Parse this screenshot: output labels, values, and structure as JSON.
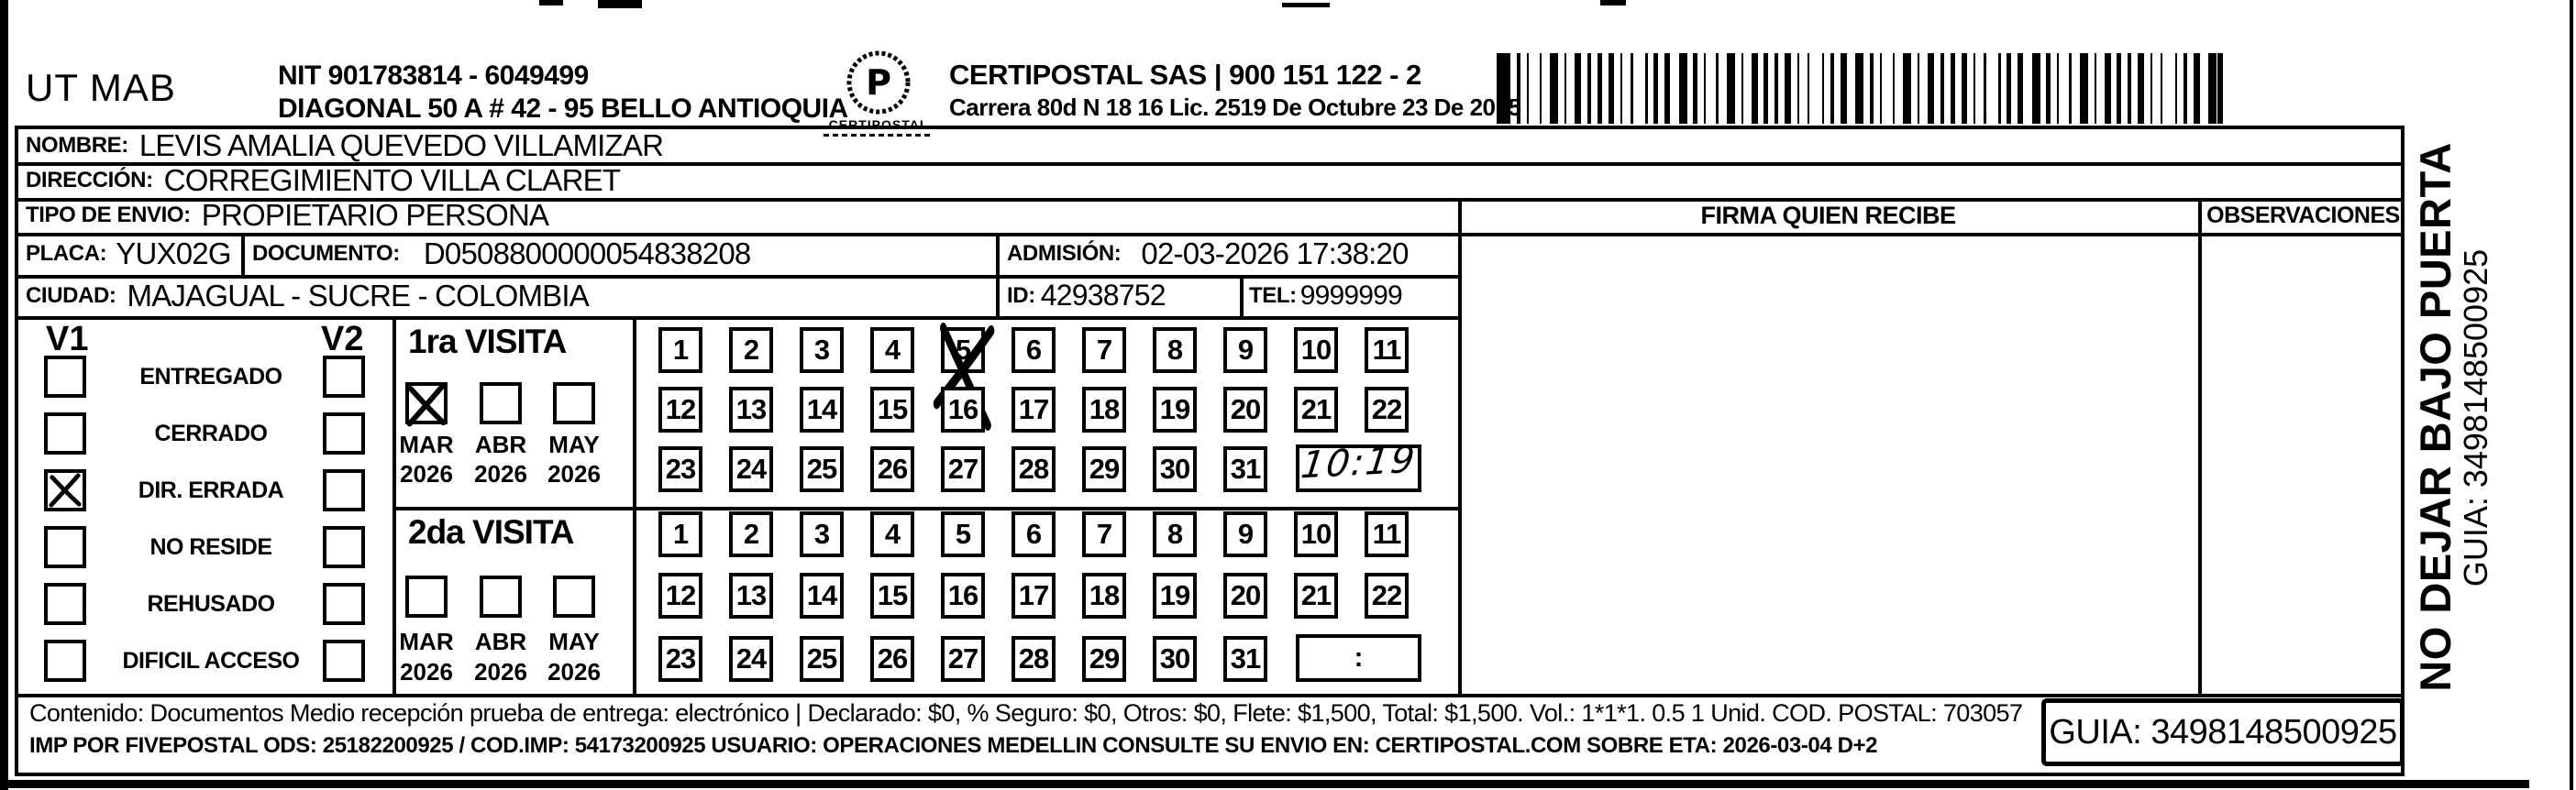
{
  "header": {
    "sender": "UT MAB",
    "nit": "NIT 901783814 - 6049499",
    "sender_address": "DIAGONAL 50 A # 42 - 95  BELLO  ANTIOQUIA",
    "logo_caption": "CERTIPOSTAL",
    "company": "CERTIPOSTAL SAS | 900 151 122 - 2",
    "company_address": "Carrera 80d N 18 16  Lic. 2519 De Octubre 23 De 2015"
  },
  "shipment": {
    "nombre_label": "NOMBRE:",
    "nombre": "LEVIS AMALIA QUEVEDO VILLAMIZAR",
    "direccion_label": "DIRECCIÓN:",
    "direccion": "CORREGIMIENTO VILLA CLARET",
    "tipo_label": "TIPO DE ENVIO:",
    "tipo": "PROPIETARIO PERSONA",
    "placa_label": "PLACA:",
    "placa": "YUX02G",
    "documento_label": "DOCUMENTO:",
    "documento": "D0508800000054838208",
    "admision_label": "ADMISIÓN:",
    "admision": "02-03-2026 17:38:20",
    "ciudad_label": "CIUDAD:",
    "ciudad": "MAJAGUAL - SUCRE - COLOMBIA",
    "id_label": "ID:",
    "id_value": "42938752",
    "tel_label": "TEL:",
    "tel": "9999999"
  },
  "signature": {
    "firma_label": "FIRMA QUIEN RECIBE",
    "observaciones_label": "OBSERVACIONES"
  },
  "status": {
    "col1": "V1",
    "col2": "V2",
    "items": [
      {
        "label": "ENTREGADO",
        "v1": false,
        "v2": false
      },
      {
        "label": "CERRADO",
        "v1": false,
        "v2": false
      },
      {
        "label": "DIR. ERRADA",
        "v1": true,
        "v2": false
      },
      {
        "label": "NO RESIDE",
        "v1": false,
        "v2": false
      },
      {
        "label": "REHUSADO",
        "v1": false,
        "v2": false
      },
      {
        "label": "DIFICIL ACCESO",
        "v1": false,
        "v2": false
      }
    ]
  },
  "visita1": {
    "title": "1ra VISITA",
    "months": [
      {
        "label": "MAR",
        "year": "2026",
        "checked": true
      },
      {
        "label": "ABR",
        "year": "2026",
        "checked": false
      },
      {
        "label": "MAY",
        "year": "2026",
        "checked": false
      }
    ],
    "days": [
      1,
      2,
      3,
      4,
      5,
      6,
      7,
      8,
      9,
      10,
      11,
      12,
      13,
      14,
      15,
      16,
      17,
      18,
      19,
      20,
      21,
      22,
      23,
      24,
      25,
      26,
      27,
      28,
      29,
      30,
      31
    ],
    "crossed_days": [
      5
    ],
    "time_handwritten": "10:19"
  },
  "visita2": {
    "title": "2da VISITA",
    "months": [
      {
        "label": "MAR",
        "year": "2026",
        "checked": false
      },
      {
        "label": "ABR",
        "year": "2026",
        "checked": false
      },
      {
        "label": "MAY",
        "year": "2026",
        "checked": false
      }
    ],
    "days": [
      1,
      2,
      3,
      4,
      5,
      6,
      7,
      8,
      9,
      10,
      11,
      12,
      13,
      14,
      15,
      16,
      17,
      18,
      19,
      20,
      21,
      22,
      23,
      24,
      25,
      26,
      27,
      28,
      29,
      30,
      31
    ],
    "crossed_days": [],
    "time_placeholder": ":"
  },
  "footer": {
    "line1": "Contenido: Documentos Medio recepción prueba de entrega: electrónico | Declarado: $0, % Seguro: $0, Otros: $0, Flete: $1,500, Total: $1,500. Vol.: 1*1*1. 0.5  1 Unid. COD. POSTAL: 703057",
    "line2": "IMP POR FIVEPOSTAL ODS: 25182200925 / COD.IMP: 54173200925 USUARIO: OPERACIONES MEDELLIN CONSULTE SU ENVIO EN: CERTIPOSTAL.COM SOBRE ETA: 2026-03-04 D+2",
    "guia": "GUIA: 3498148500925"
  },
  "side": {
    "warning": "NO DEJAR BAJO PUERTA",
    "guia": "GUIA: 3498148500925"
  }
}
